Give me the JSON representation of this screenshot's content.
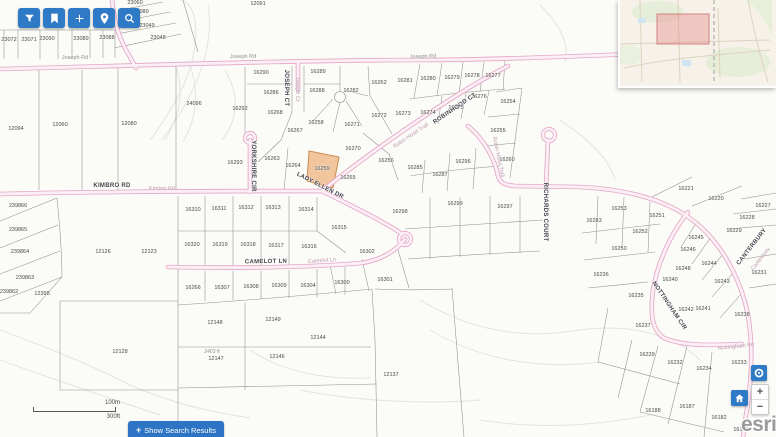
{
  "colors": {
    "accent": "#2e7ac6",
    "accent2": "#2d74c4",
    "road_edge": "#e5a6c6",
    "road_fill": "#fbeef5",
    "highlight_fill": "#f2c69d",
    "highlight_stroke": "#c98b4e",
    "extent_fill": "rgba(233,130,130,0.38)",
    "extent_stroke": "#cf8383"
  },
  "toolbar": {
    "buttons": [
      {
        "icon": "filter",
        "name": "filter"
      },
      {
        "icon": "bookmark",
        "name": "bookmarks"
      },
      {
        "icon": "add",
        "name": "add"
      },
      {
        "icon": "pin",
        "name": "locate-address"
      },
      {
        "icon": "search",
        "name": "search"
      }
    ]
  },
  "map": {
    "highlight": {
      "label": "16259"
    },
    "street_labels": [
      {
        "t": "Joseph Rd",
        "x": 75,
        "y": 58,
        "r": 0,
        "k": "gray"
      },
      {
        "t": "Joseph Rd",
        "x": 243,
        "y": 57,
        "r": -1,
        "k": "gray"
      },
      {
        "t": "Joseph Rd",
        "x": 423,
        "y": 57,
        "r": -2,
        "k": "gray"
      },
      {
        "t": "JOSEPH CT",
        "x": 286,
        "y": 88,
        "r": 90,
        "k": "dark"
      },
      {
        "t": "Joseph Ct",
        "x": 297,
        "y": 89,
        "r": 90,
        "k": "faint"
      },
      {
        "t": "YORKSHIRE CIR",
        "x": 253,
        "y": 166,
        "r": 90,
        "k": "dark"
      },
      {
        "t": "KIMBRO RD",
        "x": 112,
        "y": 186,
        "r": 0,
        "k": "dark"
      },
      {
        "t": "Kimbro Rd",
        "x": 162,
        "y": 189,
        "r": 0,
        "k": "faint"
      },
      {
        "t": "LADY ELLEN DR",
        "x": 320,
        "y": 186,
        "r": 27,
        "k": "dark"
      },
      {
        "t": "Robin Hood Trail",
        "x": 411,
        "y": 136,
        "r": -34,
        "k": "faint"
      },
      {
        "t": "ROBINHOOD CT",
        "x": 455,
        "y": 109,
        "r": -34,
        "k": "dark"
      },
      {
        "t": "Robin Hood Trail",
        "x": 498,
        "y": 157,
        "r": 78,
        "k": "faint"
      },
      {
        "t": "RICHARDS COURT",
        "x": 545,
        "y": 212,
        "r": 90,
        "k": "dark"
      },
      {
        "t": "CAMELOT LN",
        "x": 266,
        "y": 262,
        "r": -1,
        "k": "dark"
      },
      {
        "t": "Camelot Ln",
        "x": 322,
        "y": 261,
        "r": -4,
        "k": "faint"
      },
      {
        "t": "CANTERBURY",
        "x": 752,
        "y": 247,
        "r": -52,
        "k": "dark"
      },
      {
        "t": "Canterbury",
        "x": 761,
        "y": 259,
        "r": -52,
        "k": "faint"
      },
      {
        "t": "NOTTINGHAM CIR",
        "x": 669,
        "y": 306,
        "r": 56,
        "k": "dark"
      },
      {
        "t": "Nottingham Rd",
        "x": 736,
        "y": 347,
        "r": -6,
        "k": "faint"
      }
    ],
    "parcel_labels": [
      {
        "t": "23072",
        "x": 9,
        "y": 40
      },
      {
        "t": "23071",
        "x": 29,
        "y": 40
      },
      {
        "t": "23090",
        "x": 47,
        "y": 39
      },
      {
        "t": "23089",
        "x": 81,
        "y": 39
      },
      {
        "t": "23088",
        "x": 107,
        "y": 38
      },
      {
        "t": "23060",
        "x": 135,
        "y": 3
      },
      {
        "t": "23080",
        "x": 141,
        "y": 12
      },
      {
        "t": "23049",
        "x": 147,
        "y": 26
      },
      {
        "t": "23048",
        "x": 158,
        "y": 38
      },
      {
        "t": "12091",
        "x": 258,
        "y": 4
      },
      {
        "t": "12094",
        "x": 16,
        "y": 129
      },
      {
        "t": "12060",
        "x": 60,
        "y": 125
      },
      {
        "t": "12080",
        "x": 129,
        "y": 124
      },
      {
        "t": "24096",
        "x": 194,
        "y": 104
      },
      {
        "t": "16290",
        "x": 261,
        "y": 73
      },
      {
        "t": "16289",
        "x": 318,
        "y": 72
      },
      {
        "t": "16286",
        "x": 271,
        "y": 93
      },
      {
        "t": "16288",
        "x": 317,
        "y": 91
      },
      {
        "t": "16282",
        "x": 351,
        "y": 91
      },
      {
        "t": "16262",
        "x": 379,
        "y": 83
      },
      {
        "t": "16281",
        "x": 405,
        "y": 81
      },
      {
        "t": "16280",
        "x": 428,
        "y": 79
      },
      {
        "t": "16279",
        "x": 452,
        "y": 78
      },
      {
        "t": "16278",
        "x": 472,
        "y": 76
      },
      {
        "t": "16277",
        "x": 493,
        "y": 76
      },
      {
        "t": "16276",
        "x": 479,
        "y": 97
      },
      {
        "t": "16254",
        "x": 508,
        "y": 102
      },
      {
        "t": "16275",
        "x": 456,
        "y": 108
      },
      {
        "t": "16274",
        "x": 428,
        "y": 113
      },
      {
        "t": "16273",
        "x": 403,
        "y": 114
      },
      {
        "t": "16272",
        "x": 379,
        "y": 116
      },
      {
        "t": "16271",
        "x": 352,
        "y": 125
      },
      {
        "t": "16292",
        "x": 240,
        "y": 109
      },
      {
        "t": "16268",
        "x": 275,
        "y": 113
      },
      {
        "t": "16258",
        "x": 316,
        "y": 123
      },
      {
        "t": "16267",
        "x": 295,
        "y": 131
      },
      {
        "t": "16270",
        "x": 353,
        "y": 149
      },
      {
        "t": "16255",
        "x": 498,
        "y": 131
      },
      {
        "t": "16260",
        "x": 507,
        "y": 160
      },
      {
        "t": "16293",
        "x": 235,
        "y": 163
      },
      {
        "t": "16263",
        "x": 272,
        "y": 159
      },
      {
        "t": "16264",
        "x": 293,
        "y": 166
      },
      {
        "t": "16259",
        "x": 322,
        "y": 169
      },
      {
        "t": "16256",
        "x": 386,
        "y": 161
      },
      {
        "t": "16265",
        "x": 348,
        "y": 178
      },
      {
        "t": "16285",
        "x": 415,
        "y": 168
      },
      {
        "t": "16287",
        "x": 440,
        "y": 175
      },
      {
        "t": "16296",
        "x": 463,
        "y": 162
      },
      {
        "t": "16298",
        "x": 400,
        "y": 212
      },
      {
        "t": "16299",
        "x": 455,
        "y": 204
      },
      {
        "t": "16297",
        "x": 505,
        "y": 207
      },
      {
        "t": "16310",
        "x": 193,
        "y": 210
      },
      {
        "t": "16311",
        "x": 219,
        "y": 209
      },
      {
        "t": "16312",
        "x": 246,
        "y": 208
      },
      {
        "t": "16313",
        "x": 273,
        "y": 208
      },
      {
        "t": "16314",
        "x": 306,
        "y": 210
      },
      {
        "t": "16315",
        "x": 339,
        "y": 228
      },
      {
        "t": "16320",
        "x": 192,
        "y": 245
      },
      {
        "t": "16319",
        "x": 220,
        "y": 245
      },
      {
        "t": "16318",
        "x": 248,
        "y": 245
      },
      {
        "t": "16317",
        "x": 276,
        "y": 246
      },
      {
        "t": "16316",
        "x": 309,
        "y": 247
      },
      {
        "t": "16302",
        "x": 367,
        "y": 252
      },
      {
        "t": "12126",
        "x": 103,
        "y": 252
      },
      {
        "t": "12123",
        "x": 149,
        "y": 252
      },
      {
        "t": "16266",
        "x": 193,
        "y": 288
      },
      {
        "t": "16307",
        "x": 222,
        "y": 288
      },
      {
        "t": "16308",
        "x": 251,
        "y": 287
      },
      {
        "t": "16309",
        "x": 279,
        "y": 286
      },
      {
        "t": "16304",
        "x": 308,
        "y": 286
      },
      {
        "t": "16300",
        "x": 342,
        "y": 283
      },
      {
        "t": "16301",
        "x": 385,
        "y": 280
      },
      {
        "t": "12148",
        "x": 215,
        "y": 323
      },
      {
        "t": "12149",
        "x": 273,
        "y": 320
      },
      {
        "t": "12144",
        "x": 318,
        "y": 338
      },
      {
        "t": "2403 ft",
        "x": 212,
        "y": 352,
        "k": "note"
      },
      {
        "t": "12147",
        "x": 216,
        "y": 359
      },
      {
        "t": "12146",
        "x": 277,
        "y": 357
      },
      {
        "t": "12128",
        "x": 120,
        "y": 352
      },
      {
        "t": "12137",
        "x": 391,
        "y": 375
      },
      {
        "t": "239866",
        "x": 18,
        "y": 206
      },
      {
        "t": "239865",
        "x": 18,
        "y": 230
      },
      {
        "t": "239864",
        "x": 20,
        "y": 252
      },
      {
        "t": "239863",
        "x": 25,
        "y": 278
      },
      {
        "t": "239862",
        "x": 9,
        "y": 292
      },
      {
        "t": "12398",
        "x": 42,
        "y": 294
      },
      {
        "t": "16221",
        "x": 686,
        "y": 189
      },
      {
        "t": "16220",
        "x": 716,
        "y": 199
      },
      {
        "t": "16227",
        "x": 763,
        "y": 206
      },
      {
        "t": "16228",
        "x": 747,
        "y": 218
      },
      {
        "t": "16229",
        "x": 734,
        "y": 231
      },
      {
        "t": "16231",
        "x": 759,
        "y": 273
      },
      {
        "t": "16253",
        "x": 619,
        "y": 209
      },
      {
        "t": "16283",
        "x": 594,
        "y": 221
      },
      {
        "t": "16251",
        "x": 657,
        "y": 216
      },
      {
        "t": "16252",
        "x": 640,
        "y": 232
      },
      {
        "t": "16250",
        "x": 619,
        "y": 249
      },
      {
        "t": "16245",
        "x": 696,
        "y": 238
      },
      {
        "t": "16246",
        "x": 688,
        "y": 250
      },
      {
        "t": "16244",
        "x": 709,
        "y": 264
      },
      {
        "t": "16248",
        "x": 683,
        "y": 269
      },
      {
        "t": "16240",
        "x": 670,
        "y": 280
      },
      {
        "t": "16243",
        "x": 722,
        "y": 282
      },
      {
        "t": "16236",
        "x": 601,
        "y": 275
      },
      {
        "t": "16235",
        "x": 636,
        "y": 296
      },
      {
        "t": "16238",
        "x": 742,
        "y": 315
      },
      {
        "t": "16242",
        "x": 686,
        "y": 310
      },
      {
        "t": "16241",
        "x": 703,
        "y": 309
      },
      {
        "t": "16237",
        "x": 643,
        "y": 326
      },
      {
        "t": "16239",
        "x": 647,
        "y": 355
      },
      {
        "t": "16232",
        "x": 675,
        "y": 363
      },
      {
        "t": "16234",
        "x": 704,
        "y": 369
      },
      {
        "t": "16233",
        "x": 739,
        "y": 363
      },
      {
        "t": "16188",
        "x": 653,
        "y": 411
      },
      {
        "t": "16187",
        "x": 687,
        "y": 407
      },
      {
        "t": "16182",
        "x": 719,
        "y": 418
      },
      {
        "t": "16145",
        "x": 741,
        "y": 430
      }
    ]
  },
  "scalebar": {
    "metric": "100m",
    "imperial": "300ft"
  },
  "search_button": {
    "plus": "+",
    "label": "Show Search Results"
  },
  "zoom_controls": {
    "plus": "+",
    "minus": "−"
  },
  "branding": {
    "logo": "esri"
  }
}
